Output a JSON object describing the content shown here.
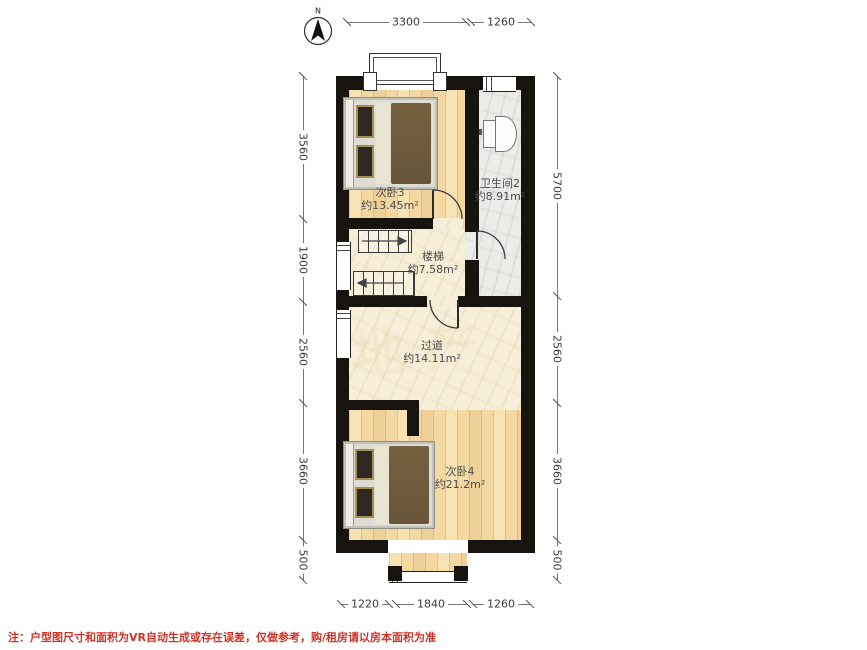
{
  "compass": {
    "label": "N"
  },
  "rooms": [
    {
      "name": "次卧3",
      "area": "约13.45m²"
    },
    {
      "name": "卫生间2",
      "area": "约8.91m²"
    },
    {
      "name": "楼梯",
      "area": "约7.58m²"
    },
    {
      "name": "过道",
      "area": "约14.11m²"
    },
    {
      "name": "次卧4",
      "area": "约21.2m²"
    }
  ],
  "dims": {
    "top": [
      "3300",
      "1260"
    ],
    "bottom": [
      "1220",
      "1840",
      "1260"
    ],
    "left": [
      "3560",
      "1900",
      "2560",
      "3660",
      "500"
    ],
    "right": [
      "5700",
      "2560",
      "3660",
      "500"
    ]
  },
  "note": "注：户型图尺寸和面积为VR自动生成或存在误差，仅做参考，购/租房请以房本面积为准",
  "watermark": "地产",
  "colors": {
    "wall": "#17130e",
    "wood_floor": "#f3d8a2",
    "stone_floor": "#f6eed8",
    "tile_floor": "#ebebe8",
    "note_red": "#d03326",
    "dim_text": "#3a3a3a"
  }
}
